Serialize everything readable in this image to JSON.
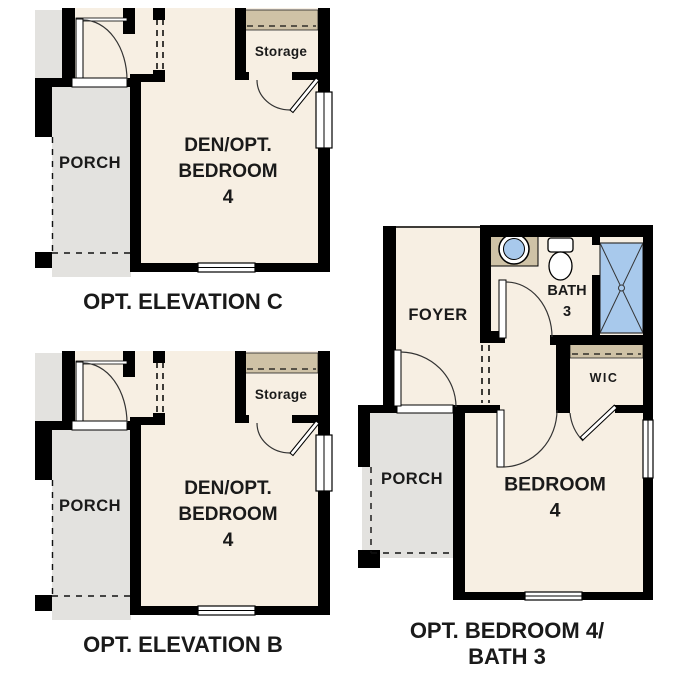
{
  "document": {
    "type": "floor-plan-sheet",
    "background": "#ffffff"
  },
  "colors": {
    "floor": "#f7efe3",
    "porch_floor": "#e3e2df",
    "shelf_tan": "#cfc2a6",
    "fixture_blue": "#a8c9ec",
    "wall": "#000000",
    "text": "#1a1a1a"
  },
  "plans": [
    {
      "caption": "OPT. ELEVATION C",
      "rooms": {
        "porch": "PORCH",
        "den": "DEN/OPT.\nBEDROOM 4",
        "storage": "Storage"
      }
    },
    {
      "caption": "OPT. ELEVATION B",
      "rooms": {
        "porch": "PORCH",
        "den": "DEN/OPT.\nBEDROOM 4",
        "storage": "Storage"
      }
    },
    {
      "caption": "OPT. BEDROOM 4/\nBATH 3",
      "rooms": {
        "foyer": "FOYER",
        "bath": "BATH\n3",
        "wic": "WIC",
        "porch": "PORCH",
        "bedroom": "BEDROOM 4"
      }
    }
  ]
}
